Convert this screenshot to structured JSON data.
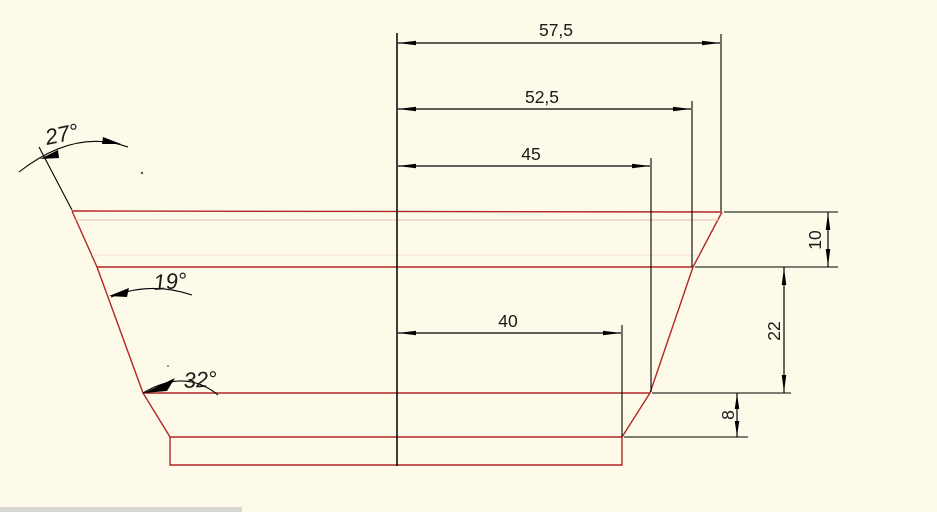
{
  "drawing": {
    "background_color": "#fdfae9",
    "outline_color": "#b22626",
    "dimension_color": "#000000",
    "inner_faint_line_color": "#eccabc",
    "dimensions": {
      "horizontal": [
        {
          "name": "top-outer-half-width",
          "label": "57,5"
        },
        {
          "name": "rim-half-width",
          "label": "52,5"
        },
        {
          "name": "upper-body-half-width",
          "label": "45"
        },
        {
          "name": "lower-body-half-width",
          "label": "40"
        }
      ],
      "vertical": [
        {
          "name": "top-band-height",
          "label": "10"
        },
        {
          "name": "middle-band-height",
          "label": "22"
        },
        {
          "name": "bottom-band-height",
          "label": "8"
        }
      ],
      "angles": [
        {
          "name": "top-wall-angle",
          "label": "27°"
        },
        {
          "name": "middle-wall-angle",
          "label": "19°"
        },
        {
          "name": "bottom-wall-angle",
          "label": "32°"
        }
      ]
    }
  }
}
